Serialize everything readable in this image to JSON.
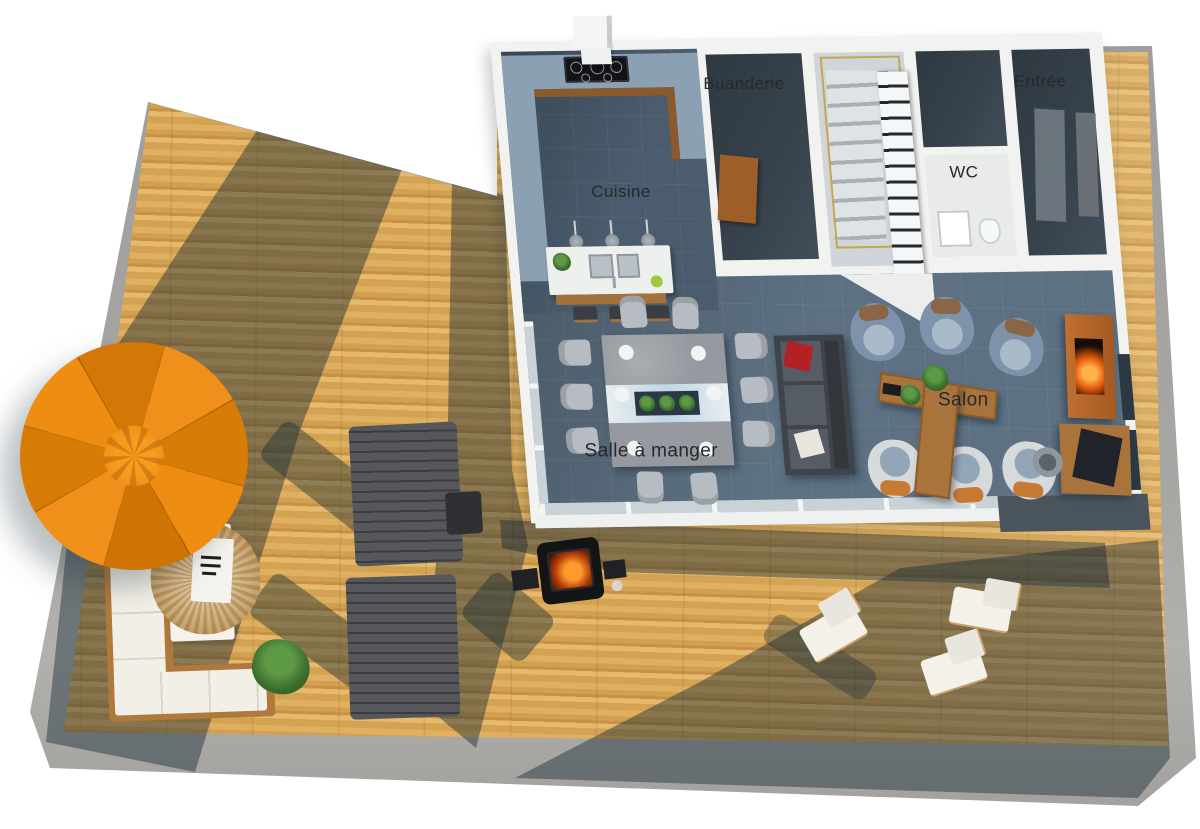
{
  "rooms": [
    {
      "id": "buanderie",
      "label": "Buanderie"
    },
    {
      "id": "entree",
      "label": "Entrée"
    },
    {
      "id": "wc",
      "label": "WC"
    },
    {
      "id": "cuisine",
      "label": "Cuisine"
    },
    {
      "id": "salle-a-manger",
      "label": "Salle à manger"
    },
    {
      "id": "salon",
      "label": "Salon"
    }
  ],
  "colors": {
    "umbrella": "#ef8c10",
    "umbrella_dark": "#d47a05",
    "deck_wood": "#d9a755",
    "concrete": "#a8a7a4",
    "interior_tile": "#5d7183",
    "kitchen_floor": "#4a5c6d",
    "dark_floor": "#37424c",
    "wall": "#f2f3f1",
    "counter_blue": "#8ba0b2",
    "wood": "#b0793c",
    "armchair": "#7e92ab",
    "sofa": "#3f444a",
    "red_pillow": "#b51f26",
    "gold_railing": "#c8a550",
    "fire": "#ff9a2e",
    "label_text": "#26282b"
  }
}
